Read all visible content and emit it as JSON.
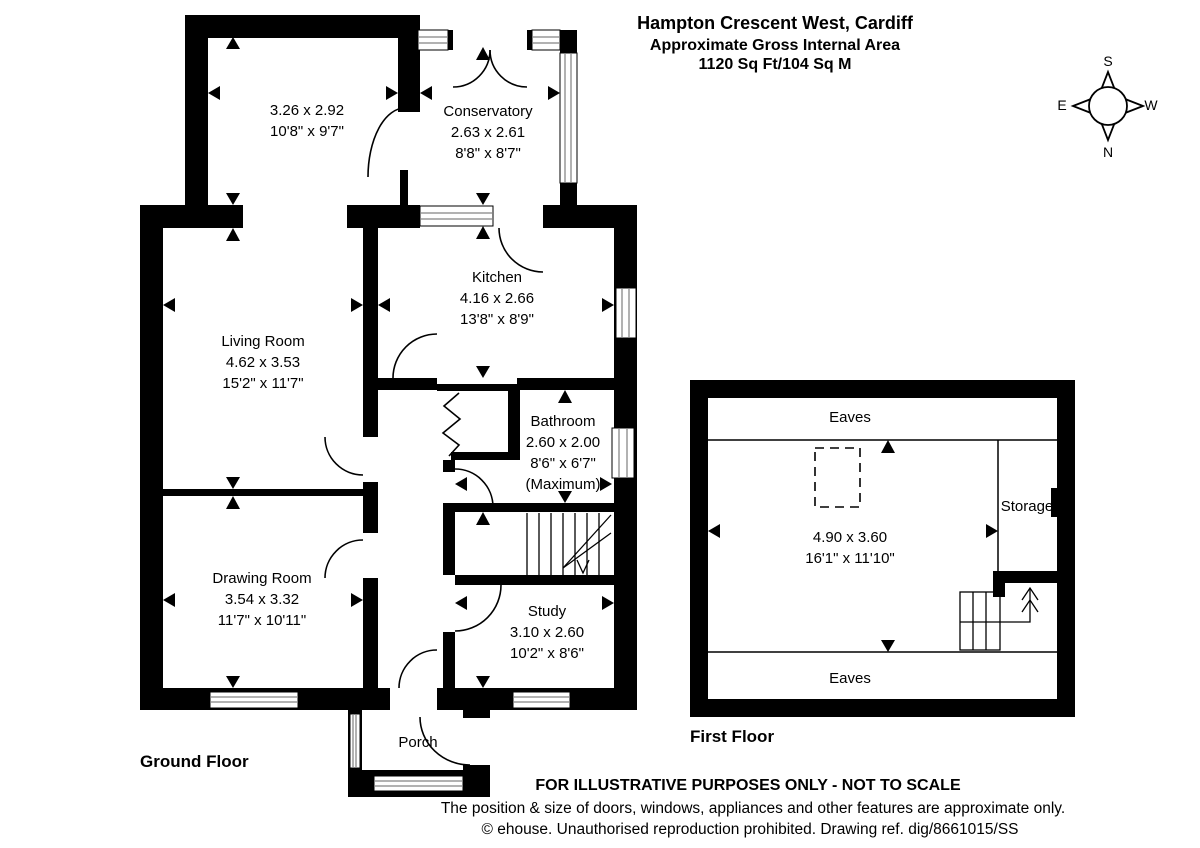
{
  "title": {
    "address": "Hampton Crescent West, Cardiff",
    "subtitle": "Approximate Gross Internal Area",
    "area": "1120 Sq Ft/104 Sq M"
  },
  "compass": {
    "north": "N",
    "south": "S",
    "east": "E",
    "west": "W"
  },
  "ground_floor": {
    "label": "Ground Floor",
    "reception_room": {
      "metric": "3.26 x 2.92",
      "imperial": "10'8\" x 9'7\""
    },
    "conservatory": {
      "name": "Conservatory",
      "metric": "2.63 x 2.61",
      "imperial": "8'8\" x 8'7\""
    },
    "kitchen": {
      "name": "Kitchen",
      "metric": "4.16 x 2.66",
      "imperial": "13'8\" x 8'9\""
    },
    "living_room": {
      "name": "Living Room",
      "metric": "4.62 x 3.53",
      "imperial": "15'2\" x 11'7\""
    },
    "bathroom": {
      "name": "Bathroom",
      "metric": "2.60 x 2.00",
      "imperial": "8'6\" x 6'7\"",
      "note": "(Maximum)"
    },
    "drawing_room": {
      "name": "Drawing Room",
      "metric": "3.54 x 3.32",
      "imperial": "11'7\" x 10'11\""
    },
    "study": {
      "name": "Study",
      "metric": "3.10 x 2.60",
      "imperial": "10'2\" x 8'6\""
    },
    "porch": {
      "name": "Porch"
    }
  },
  "first_floor": {
    "label": "First Floor",
    "loft_room": {
      "metric": "4.90 x 3.60",
      "imperial": "16'1\" x 11'10\""
    },
    "storage": {
      "name": "Storage"
    },
    "eaves_top": {
      "name": "Eaves"
    },
    "eaves_bottom": {
      "name": "Eaves"
    }
  },
  "footer": {
    "disclaimer": "FOR ILLUSTRATIVE PURPOSES ONLY - NOT TO SCALE",
    "approx_note": "The position & size of doors, windows, appliances and other features are approximate only.",
    "copyright": "© ehouse. Unauthorised reproduction prohibited. Drawing ref. dig/8661015/SS"
  }
}
